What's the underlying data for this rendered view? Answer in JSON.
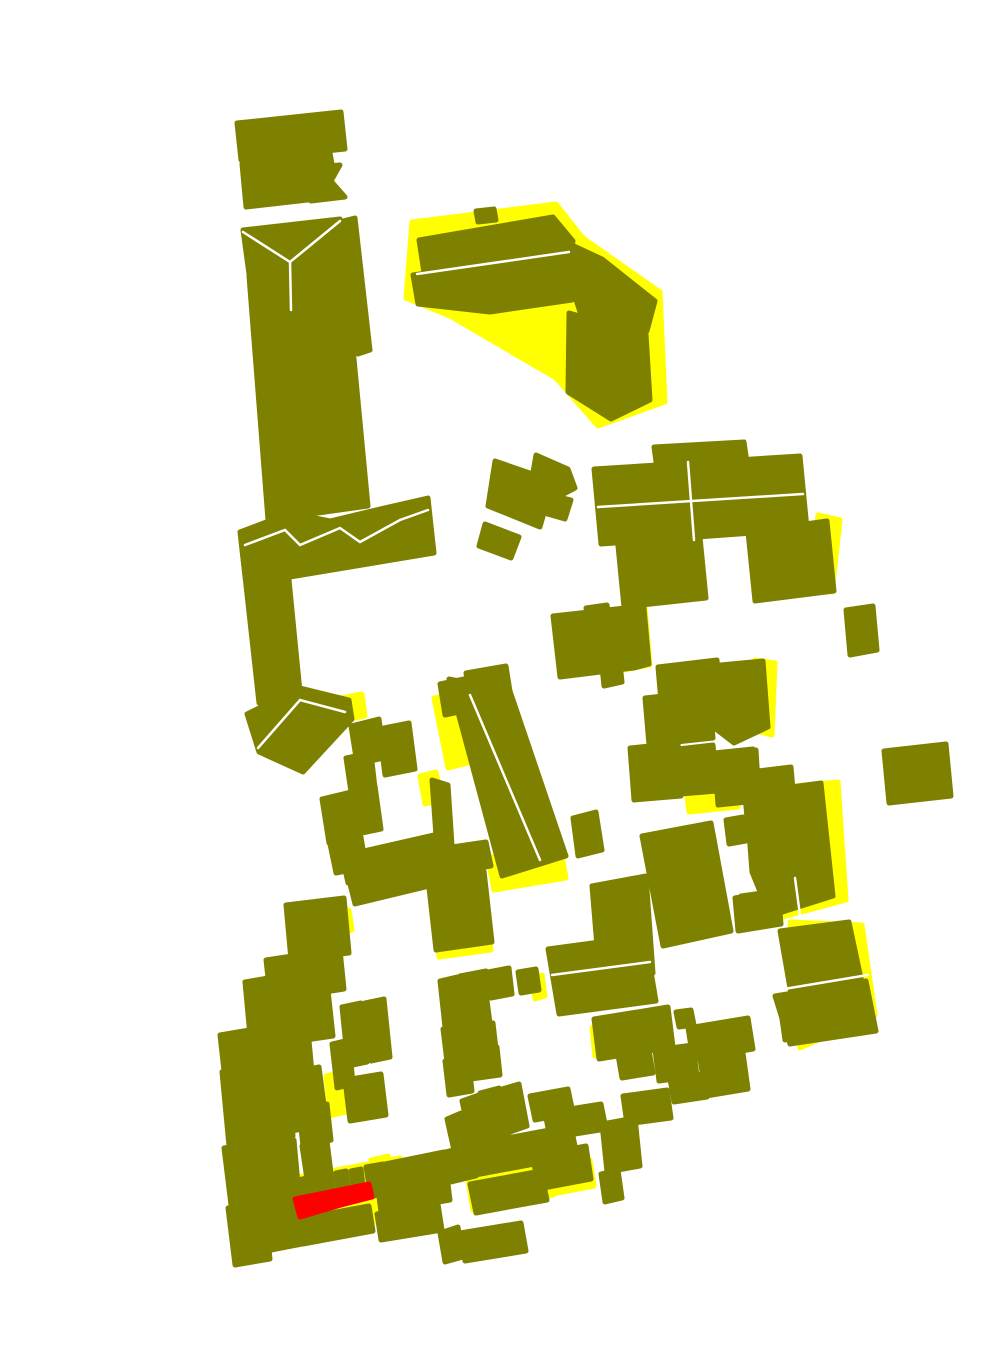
{
  "canvas": {
    "width": 1000,
    "height": 1370,
    "background": "#ffffff"
  },
  "colors": {
    "olive": "#7e8000",
    "yellow": "#ffff00",
    "red": "#ff0000",
    "separator": "#ffffff"
  },
  "regions": {
    "yellow": [
      {
        "name": "yellow-bent-building-fringe",
        "points": "412,222 556,204 583,238 660,292 665,402 598,426 556,378 450,316 406,298"
      },
      {
        "name": "yellow-central-left-fringe",
        "points": "434,698 458,692 472,762 448,768"
      },
      {
        "name": "yellow-central-bottom-fringe",
        "points": "488,858 560,845 566,878 494,890"
      },
      {
        "name": "yellow-chimney-fringe",
        "points": "420,776 436,772 442,800 425,804"
      },
      {
        "name": "yellow-k-right-fringe",
        "points": "755,660 775,663 772,735 752,730"
      },
      {
        "name": "yellow-g-right-fringe",
        "points": "618,612 645,608 650,665 624,670"
      },
      {
        "name": "yellow-n-right-fringe",
        "points": "790,922 862,925 875,1015 800,1048"
      },
      {
        "name": "yellow-l-right-fringe",
        "points": "752,790 838,782 846,900 772,920"
      },
      {
        "name": "yellow-comb-underlay",
        "points": "293,1178 400,1158 406,1215 300,1236"
      },
      {
        "name": "yellow-wedge-band",
        "points": "326,1076 350,1070 354,1110 330,1116"
      },
      {
        "name": "yellow-k-low-fringe",
        "points": "686,788 735,783 738,807 689,812"
      },
      {
        "name": "yellow-h4-bottom-fringe",
        "points": "436,936 488,928 491,950 439,957"
      },
      {
        "name": "yellow-p-low-fringe",
        "points": "468,1180 548,1165 553,1195 473,1210"
      },
      {
        "name": "yellow-y2-fringe",
        "points": "533,1172 590,1160 594,1186 537,1197"
      },
      {
        "name": "yellow-band-top-fringe",
        "points": "330,915 349,910 352,930 333,934"
      },
      {
        "name": "yellow-o1-fringe",
        "points": "592,1028 608,1024 611,1052 595,1056"
      },
      {
        "name": "yellow-i-right-fringe",
        "points": "818,515 840,520 832,592 812,585"
      },
      {
        "name": "yellow-q-right-fringe",
        "points": "371,1160 388,1156 391,1176 374,1180"
      },
      {
        "name": "yellow-s-right-fringe",
        "points": "532,978 542,975 545,996 535,999"
      },
      {
        "name": "yellow-t6-right-fringe",
        "points": "615,975 628,972 631,990 618,993"
      },
      {
        "name": "yellow-triangle-tip-fringe",
        "points": "330,700 362,694 365,716 333,722"
      }
    ],
    "olive": [
      {
        "name": "building-a1",
        "points": "237,123 341,112 345,149 241,160"
      },
      {
        "name": "building-a2",
        "points": "242,164 330,153 334,175 322,180 334,197 246,207"
      },
      {
        "name": "building-a3-bowtie",
        "points": "316,167 340,165 331,181 345,197 311,201 324,183"
      },
      {
        "name": "building-b1-gable-band",
        "points": "243,230 340,219 345,262 249,274"
      },
      {
        "name": "building-b2-column",
        "points": "249,276 345,264 368,506 268,520"
      },
      {
        "name": "building-b3-sliver",
        "points": "343,221 355,218 370,350 358,354"
      },
      {
        "name": "building-c1-arm",
        "points": "240,532 290,513 330,521 380,509 428,498 434,553 290,577 245,576"
      },
      {
        "name": "building-c2-lower-column",
        "points": "241,540 286,549 300,692 259,703"
      },
      {
        "name": "building-c3-triangle",
        "points": "247,714 300,688 349,700 352,719 303,772 259,752"
      },
      {
        "name": "building-d1",
        "points": "419,240 553,217 573,241 570,259 424,273"
      },
      {
        "name": "building-d2",
        "points": "413,275 568,252 572,300 490,312 418,304"
      },
      {
        "name": "building-d3-bend",
        "points": "574,246 602,259 655,301 647,331 580,312 566,269"
      },
      {
        "name": "building-d4-leg",
        "points": "569,313 646,334 650,400 611,419 568,392"
      },
      {
        "name": "building-d-chimney",
        "points": "476,211 494,209 496,220 478,222"
      },
      {
        "name": "building-e1",
        "points": "536,455 568,469 575,488 558,497 533,472"
      },
      {
        "name": "building-e2",
        "points": "495,461 553,481 540,527 488,506"
      },
      {
        "name": "building-e3",
        "points": "485,524 519,537 511,558 479,546"
      },
      {
        "name": "building-e4",
        "points": "547,494 571,500 565,519 544,513"
      },
      {
        "name": "building-f1",
        "points": "440,684 464,679 469,710 445,715"
      },
      {
        "name": "building-f2",
        "points": "466,673 506,666 512,704 472,711"
      },
      {
        "name": "building-g1",
        "points": "553,616 625,608 633,668 560,677"
      },
      {
        "name": "building-g2",
        "points": "628,611 644,608 649,664 634,668"
      },
      {
        "name": "building-g-chimney",
        "points": "586,608 607,605 609,616 588,619"
      },
      {
        "name": "building-g4",
        "points": "601,658 619,654 622,682 604,686"
      },
      {
        "name": "building-h1-large",
        "points": "449,679 510,691 566,856 502,876"
      },
      {
        "name": "building-h-chimney",
        "points": "432,780 448,785 453,860 438,864"
      },
      {
        "name": "building-h3-bar",
        "points": "425,851 486,842 491,866 429,876"
      },
      {
        "name": "building-h4",
        "points": "428,879 484,871 492,942 436,950"
      },
      {
        "name": "building-h5",
        "points": "573,818 596,812 602,850 578,856"
      },
      {
        "name": "building-i-top",
        "points": "654,447 744,442 748,470 658,476"
      },
      {
        "name": "building-i-main",
        "points": "594,469 800,456 807,529 601,544"
      },
      {
        "name": "building-i-right",
        "points": "748,532 827,521 834,591 755,601"
      },
      {
        "name": "building-i-tab",
        "points": "618,546 700,537 706,598 624,607"
      },
      {
        "name": "building-j",
        "points": "846,610 873,606 877,650 850,655"
      },
      {
        "name": "building-k1",
        "points": "630,637 644,634 646,659 632,662"
      },
      {
        "name": "building-k2",
        "points": "658,667 717,660 720,695 661,702"
      },
      {
        "name": "building-k3",
        "points": "645,698 709,691 713,738 649,745"
      },
      {
        "name": "building-k4",
        "points": "710,666 763,661 768,727 734,743 708,723"
      },
      {
        "name": "building-k5",
        "points": "630,748 678,743 681,796 634,800"
      },
      {
        "name": "building-k6",
        "points": "678,749 713,745 717,791 681,794"
      },
      {
        "name": "building-k7",
        "points": "714,753 753,749 757,801 718,805"
      },
      {
        "name": "building-k8",
        "points": "758,771 791,767 794,801 761,804"
      },
      {
        "name": "building-k9",
        "points": "744,784 791,779 794,814 747,818"
      },
      {
        "name": "building-k-square",
        "points": "726,820 743,817 746,841 729,844"
      },
      {
        "name": "building-l1",
        "points": "742,753 756,750 759,799 745,801"
      },
      {
        "name": "building-l2",
        "points": "748,776 789,771 791,791 751,796"
      },
      {
        "name": "building-l3-large",
        "points": "746,793 821,783 833,896 770,916 752,872"
      },
      {
        "name": "building-l4",
        "points": "741,896 776,891 779,921 744,926"
      },
      {
        "name": "building-m1",
        "points": "884,751 946,744 951,796 889,803"
      },
      {
        "name": "building-n1",
        "points": "780,931 849,922 862,983 791,994"
      },
      {
        "name": "building-n2",
        "points": "775,996 866,981 876,1031 790,1044"
      },
      {
        "name": "building-t1",
        "points": "642,836 711,823 731,931 663,946"
      },
      {
        "name": "building-t3",
        "points": "735,898 778,890 781,924 738,931"
      },
      {
        "name": "building-t4",
        "points": "592,886 646,876 653,973 600,983"
      },
      {
        "name": "building-t5",
        "points": "600,973 617,969 621,992 604,996"
      },
      {
        "name": "building-t6",
        "points": "548,949 645,936 656,1001 559,1014"
      },
      {
        "name": "building-w1a",
        "points": "688,1028 748,1018 753,1049 693,1059"
      },
      {
        "name": "building-w1b",
        "points": "700,1059 743,1053 748,1089 706,1096"
      },
      {
        "name": "building-v",
        "points": "781,1012 796,1008 800,1036 785,1040"
      },
      {
        "name": "building-o1",
        "points": "594,1019 668,1007 673,1047 599,1059"
      },
      {
        "name": "building-o2",
        "points": "676,1012 691,1010 694,1025 679,1027"
      },
      {
        "name": "building-o3",
        "points": "618,1055 649,1050 653,1073 622,1078"
      },
      {
        "name": "building-o4",
        "points": "655,1050 693,1045 697,1076 659,1081"
      },
      {
        "name": "building-o5",
        "points": "670,1079 703,1074 707,1097 674,1102"
      },
      {
        "name": "building-o6",
        "points": "623,1096 667,1090 671,1118 627,1124"
      },
      {
        "name": "building-x1",
        "points": "602,1124 635,1118 640,1166 607,1172"
      },
      {
        "name": "building-x2",
        "points": "601,1174 618,1170 622,1198 605,1202"
      },
      {
        "name": "building-s1",
        "points": "440,981 457,977 462,1023 445,1027"
      },
      {
        "name": "building-s2",
        "points": "460,976 486,971 489,992 463,997"
      },
      {
        "name": "building-s3",
        "points": "463,997 486,993 490,1023 467,1027"
      },
      {
        "name": "building-s4",
        "points": "488,972 509,968 512,994 491,998"
      },
      {
        "name": "building-s5",
        "points": "518,972 536,969 539,990 521,993"
      },
      {
        "name": "building-s6",
        "points": "468,1027 493,1023 496,1049 471,1053"
      },
      {
        "name": "building-s7",
        "points": "443,1029 466,1025 470,1058 447,1062"
      },
      {
        "name": "building-s8",
        "points": "445,1061 468,1057 472,1091 449,1095"
      },
      {
        "name": "building-s9",
        "points": "468,1051 497,1047 500,1075 471,1079"
      },
      {
        "name": "building-rl",
        "points": "342,1007 361,1003 367,1062 348,1066"
      },
      {
        "name": "building-rm",
        "points": "365,1003 384,999 390,1057 371,1061"
      },
      {
        "name": "building-rn",
        "points": "345,1080 381,1074 386,1115 350,1121"
      },
      {
        "name": "building-ra",
        "points": "286,905 344,898 349,953 291,960"
      },
      {
        "name": "building-rg",
        "points": "295,947 339,940 344,989 300,996"
      },
      {
        "name": "building-rb",
        "points": "266,960 299,955 303,991 270,996"
      },
      {
        "name": "building-rc",
        "points": "245,982 286,975 291,1029 250,1036"
      },
      {
        "name": "building-rf",
        "points": "280,997 328,990 333,1036 285,1043"
      },
      {
        "name": "building-rh",
        "points": "257,1038 308,1030 313,1083 262,1091"
      },
      {
        "name": "building-rd",
        "points": "220,1035 261,1028 267,1083 226,1089"
      },
      {
        "name": "building-ri",
        "points": "250,1092 298,1084 303,1129 255,1137"
      },
      {
        "name": "building-rs",
        "points": "222,1072 254,1065 261,1139 229,1146"
      },
      {
        "name": "building-ri2",
        "points": "252,1070 287,1063 293,1136 258,1143"
      },
      {
        "name": "building-rk",
        "points": "295,1072 319,1067 324,1105 300,1110"
      },
      {
        "name": "building-rv",
        "points": "299,1110 327,1104 331,1140 303,1146"
      },
      {
        "name": "building-rj",
        "points": "332,1044 349,1040 353,1084 337,1088"
      },
      {
        "name": "building-ro",
        "points": "224,1148 259,1142 265,1199 231,1205"
      },
      {
        "name": "building-rp",
        "points": "228,1208 264,1202 270,1259 235,1265"
      },
      {
        "name": "building-rt",
        "points": "256,1147 294,1140 300,1206 263,1213"
      },
      {
        "name": "building-ru",
        "points": "260,1215 297,1208 302,1244 266,1251"
      },
      {
        "name": "building-rw",
        "points": "302,1146 327,1141 332,1181 308,1186"
      },
      {
        "name": "building-m-up1",
        "points": "351,726 379,719 384,758 357,764"
      },
      {
        "name": "building-m-up2",
        "points": "379,729 409,723 415,769 385,775"
      },
      {
        "name": "building-m-up3",
        "points": "346,758 371,753 375,788 351,792"
      },
      {
        "name": "building-n-up1",
        "points": "322,799 351,792 357,836 329,843"
      },
      {
        "name": "building-n-up2",
        "points": "351,791 375,786 381,829 357,834"
      },
      {
        "name": "building-n-up3",
        "points": "330,844 361,837 366,867 336,873"
      },
      {
        "name": "building-bar1",
        "points": "342,856 438,834 444,861 348,883"
      },
      {
        "name": "building-bar2",
        "points": "350,884 441,862 446,882 355,904"
      },
      {
        "name": "building-p1",
        "points": "447,1119 461,1113 469,1149 455,1155"
      },
      {
        "name": "building-p2",
        "points": "462,1101 479,1095 489,1141 472,1147"
      },
      {
        "name": "building-p3",
        "points": "480,1093 499,1088 509,1133 491,1139"
      },
      {
        "name": "building-p4",
        "points": "502,1089 519,1084 527,1126 510,1132"
      },
      {
        "name": "building-p5",
        "points": "445,1152 470,1146 476,1176 451,1182"
      },
      {
        "name": "building-ph1",
        "points": "530,1096 568,1089 573,1113 535,1120"
      },
      {
        "name": "building-ph2",
        "points": "545,1113 601,1104 606,1129 550,1138"
      },
      {
        "name": "building-p-band",
        "points": "464,1146 571,1126 577,1156 470,1176"
      },
      {
        "name": "building-p-band2",
        "points": "470,1184 541,1171 547,1200 476,1213"
      },
      {
        "name": "building-y2",
        "points": "533,1156 586,1146 591,1179 538,1189"
      },
      {
        "name": "building-z1",
        "points": "440,1233 458,1227 463,1257 445,1262"
      },
      {
        "name": "building-z3",
        "points": "460,1233 521,1223 526,1251 465,1261"
      },
      {
        "name": "building-q-right-upper",
        "points": "375,1166 444,1152 450,1200 381,1212"
      },
      {
        "name": "building-q-right-lower",
        "points": "377,1214 438,1204 442,1230 381,1240"
      },
      {
        "name": "building-q-cap",
        "points": "294,1181 306,1178 309,1206 297,1209"
      },
      {
        "name": "building-q-tooth1",
        "points": "307,1179 317,1176 320,1201 310,1203"
      },
      {
        "name": "building-q-tooth2",
        "points": "321,1175 331,1173 334,1198 324,1200"
      },
      {
        "name": "building-q-tooth3",
        "points": "336,1173 346,1171 349,1196 339,1198"
      },
      {
        "name": "building-q-tooth4",
        "points": "351,1171 361,1169 364,1194 354,1196"
      },
      {
        "name": "building-q-tooth5",
        "points": "366,1167 383,1164 388,1192 371,1197"
      },
      {
        "name": "building-q-base",
        "points": "298,1219 369,1206 373,1231 303,1244"
      }
    ],
    "red": [
      {
        "name": "red-strip",
        "points": "295,1199 340,1190 369,1184 372,1197 341,1205 300,1217"
      }
    ],
    "separator_lines": [
      {
        "name": "ridge-b-gable",
        "points": "243,232 290,262 340,221"
      },
      {
        "name": "ridge-b-stem",
        "points": "290,262 291,310"
      },
      {
        "name": "ridge-d",
        "points": "417,274 569,252"
      },
      {
        "name": "ridge-c-arm",
        "points": "245,545 285,530 300,545 340,528 360,542 400,520 428,510"
      },
      {
        "name": "ridge-h",
        "points": "470,695 540,860"
      },
      {
        "name": "ridge-i-vertical",
        "points": "688,462 694,540"
      },
      {
        "name": "ridge-i-horizontal",
        "points": "598,507 803,494"
      },
      {
        "name": "ridge-n",
        "points": "778,990 868,975"
      },
      {
        "name": "ridge-l-notch",
        "points": "795,878 800,915"
      },
      {
        "name": "ridge-t6",
        "points": "552,975 650,962"
      },
      {
        "name": "ridge-c3",
        "points": "258,748 300,700 345,712"
      }
    ]
  }
}
